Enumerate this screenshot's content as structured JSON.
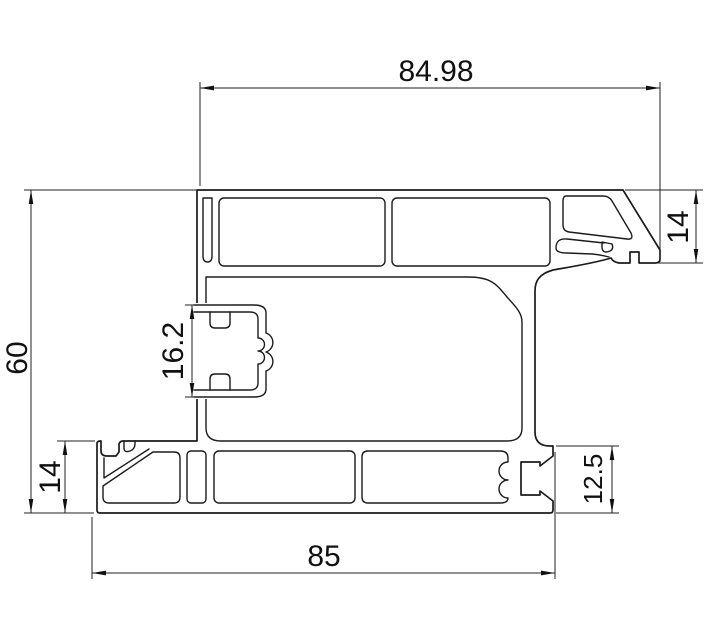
{
  "drawing": {
    "type": "technical-profile-cross-section",
    "dimensions": {
      "top_width": "84.98",
      "left_height": "60",
      "groove_height": "16.2",
      "left_foot_height": "14",
      "bottom_width": "85",
      "right_end_height": "12.5",
      "right_edge_height": "14"
    },
    "colors": {
      "line": "#1b1b1b",
      "dimension_line": "#222222",
      "text": "#111111",
      "background": "#ffffff"
    }
  }
}
